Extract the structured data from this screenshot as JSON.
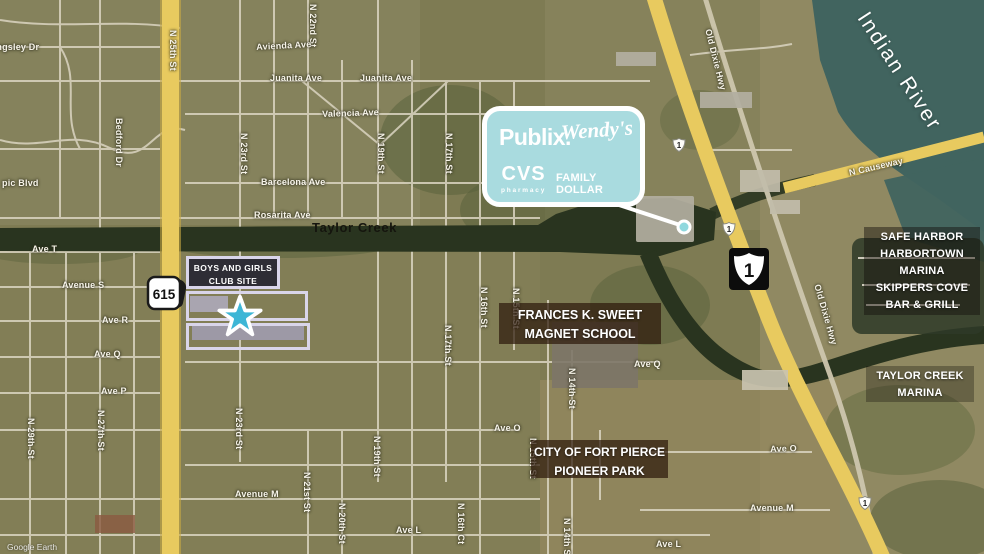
{
  "map": {
    "attribution": "Google Earth",
    "river_label": "Indian River",
    "creek_label": "Taylor Creek"
  },
  "callout": {
    "publix": "Publix.",
    "wendys": "Wendy's",
    "cvs": "CVS",
    "cvs_sub": "pharmacy",
    "family_dollar": "FAMILY DOLLAR"
  },
  "site": {
    "line1": "BOYS AND GIRLS",
    "line2": "CLUB SITE"
  },
  "shields": {
    "fl615": "615",
    "us1": "1"
  },
  "landmarks": {
    "school": {
      "lines": [
        "FRANCES K. SWEET",
        "MAGNET SCHOOL"
      ]
    },
    "park": {
      "lines": [
        "CITY OF FORT PIERCE",
        "PIONEER PARK"
      ]
    },
    "safe_harbor": {
      "lines": [
        "SAFE HARBOR",
        "HARBORTOWN",
        "MARINA",
        "SKIPPERS COVE",
        "BAR & GRILL"
      ]
    },
    "marina": {
      "lines": [
        "TAYLOR CREEK",
        "MARINA"
      ]
    }
  },
  "colors": {
    "callout_bg": "#a9dbdf",
    "site_star": "#3db6d6",
    "site_outline": "#d9d5ea",
    "highway_yellow": "#e8ca5f",
    "water": "#41645f",
    "creek": "#29341f"
  },
  "street_labels": [
    {
      "t": "Kingsley Dr",
      "x": -13,
      "y": 42,
      "r": 0
    },
    {
      "t": "N 25th St",
      "x": 178,
      "y": 30,
      "r": 90
    },
    {
      "t": "N 22nd St",
      "x": 318,
      "y": 4,
      "r": 90
    },
    {
      "t": "Avienda Ave",
      "x": 256,
      "y": 42,
      "r": -3
    },
    {
      "t": "Juanita Ave",
      "x": 270,
      "y": 73,
      "r": 0
    },
    {
      "t": "Juanita Ave",
      "x": 360,
      "y": 73,
      "r": 0
    },
    {
      "t": "Valencia Ave",
      "x": 322,
      "y": 109,
      "r": -2
    },
    {
      "t": "Bedford Dr",
      "x": 124,
      "y": 118,
      "r": 90
    },
    {
      "t": "N 23rd St",
      "x": 249,
      "y": 133,
      "r": 90
    },
    {
      "t": "N 19th St",
      "x": 386,
      "y": 133,
      "r": 90
    },
    {
      "t": "N 17th St",
      "x": 454,
      "y": 133,
      "r": 90
    },
    {
      "t": "Barcelona Ave",
      "x": 261,
      "y": 177,
      "r": 0
    },
    {
      "t": "pic Blvd",
      "x": 2,
      "y": 178,
      "r": 0
    },
    {
      "t": "Rosarita Ave",
      "x": 254,
      "y": 210,
      "r": 0
    },
    {
      "t": "Ave T",
      "x": 32,
      "y": 244,
      "r": 0
    },
    {
      "t": "Avenue S",
      "x": 62,
      "y": 280,
      "r": 0
    },
    {
      "t": "Ave R",
      "x": 102,
      "y": 315,
      "r": 0
    },
    {
      "t": "Ave Q",
      "x": 94,
      "y": 349,
      "r": 0
    },
    {
      "t": "Ave P",
      "x": 101,
      "y": 386,
      "r": 0
    },
    {
      "t": "N 17th St",
      "x": 453,
      "y": 325,
      "r": 90
    },
    {
      "t": "N 16th St",
      "x": 489,
      "y": 287,
      "r": 90
    },
    {
      "t": "N 15th St",
      "x": 521,
      "y": 288,
      "r": 90
    },
    {
      "t": "N 14th St",
      "x": 577,
      "y": 368,
      "r": 90
    },
    {
      "t": "Ave Q",
      "x": 634,
      "y": 359,
      "r": 0
    },
    {
      "t": "Ave O",
      "x": 494,
      "y": 423,
      "r": 0
    },
    {
      "t": "Ave O",
      "x": 770,
      "y": 444,
      "r": -2
    },
    {
      "t": "N 29th St",
      "x": 36,
      "y": 418,
      "r": 90
    },
    {
      "t": "N 27th St",
      "x": 106,
      "y": 410,
      "r": 90
    },
    {
      "t": "N 23rd St",
      "x": 244,
      "y": 408,
      "r": 90
    },
    {
      "t": "N 21st St",
      "x": 312,
      "y": 472,
      "r": 90
    },
    {
      "t": "N 20th St",
      "x": 347,
      "y": 503,
      "r": 90
    },
    {
      "t": "N 19th St",
      "x": 382,
      "y": 436,
      "r": 90
    },
    {
      "t": "N 16th Ct",
      "x": 466,
      "y": 503,
      "r": 90
    },
    {
      "t": "N 15th St",
      "x": 538,
      "y": 438,
      "r": 90
    },
    {
      "t": "N 14th St",
      "x": 572,
      "y": 518,
      "r": 90
    },
    {
      "t": "Avenue M",
      "x": 235,
      "y": 489,
      "r": 0
    },
    {
      "t": "Avenue M",
      "x": 750,
      "y": 503,
      "r": 0
    },
    {
      "t": "Ave L",
      "x": 396,
      "y": 525,
      "r": 0
    },
    {
      "t": "Ave L",
      "x": 656,
      "y": 539,
      "r": 0
    },
    {
      "t": "Old Dixie Hwy",
      "x": 713,
      "y": 28,
      "r": 76
    },
    {
      "t": "Old Dixie Hwy",
      "x": 822,
      "y": 283,
      "r": 74
    },
    {
      "t": "N Causeway",
      "x": 848,
      "y": 168,
      "r": -13
    }
  ]
}
